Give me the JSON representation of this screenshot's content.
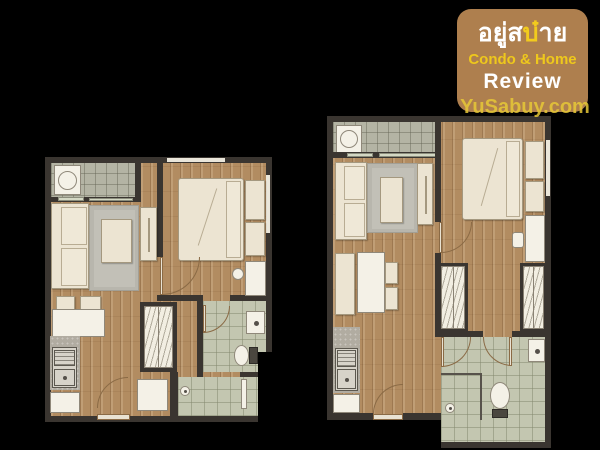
{
  "watermark": {
    "bg_color": "#ae7f4e",
    "thai_prefix": "อยู่ส",
    "thai_accent": "บ๋",
    "thai_suffix": "าย",
    "tagline": "Condo & Home",
    "tagline_color": "#eec81c",
    "review": "Review",
    "website": "YuSabuy.com",
    "website_color": "#e7c837"
  },
  "palette": {
    "background": "#000000",
    "wall": "#3a3530",
    "wood_floor": "#b28c61",
    "balcony_tile": "#b4b4a4",
    "bathroom_tile": "#c3c6b0",
    "furniture_cream": "#ece4d2",
    "fixture_white": "#f4f1e7",
    "rug_gray": "#b8b6ad",
    "counter_gray": "#b1aca1",
    "door_arc": "#8a6a45"
  },
  "floorplans": [
    {
      "id": "unit-a",
      "position": "left",
      "rooms": [
        "balcony",
        "living-room",
        "bedroom",
        "wardrobe",
        "bathroom",
        "shower",
        "kitchen-dining",
        "entrance-hall"
      ],
      "furniture": [
        "washing-machine",
        "sofa",
        "rug",
        "coffee-table",
        "tv-console",
        "double-bed",
        "bedside-cabinets",
        "vanity-desk",
        "stool",
        "dining-chairs",
        "dining-table",
        "kitchen-counter",
        "kitchen-sink",
        "base-cabinet",
        "shoe-cabinet",
        "wash-basin",
        "toilet",
        "shower-head"
      ]
    },
    {
      "id": "unit-b",
      "position": "right",
      "rooms": [
        "balcony",
        "living-room",
        "bedroom",
        "dressing-corridor",
        "bathroom",
        "shower",
        "kitchen-dining",
        "entrance-hall"
      ],
      "furniture": [
        "washing-machine",
        "sofa",
        "rug",
        "coffee-table",
        "tv-console",
        "double-bed",
        "bedside-cabinets",
        "desk",
        "desk-chair",
        "dining-bench",
        "dining-table",
        "dining-chairs",
        "wardrobe-left",
        "wardrobe-right",
        "kitchen-counter",
        "kitchen-sink",
        "base-cabinet",
        "wash-basin",
        "toilet",
        "shower-enclosure",
        "shower-head"
      ]
    }
  ]
}
